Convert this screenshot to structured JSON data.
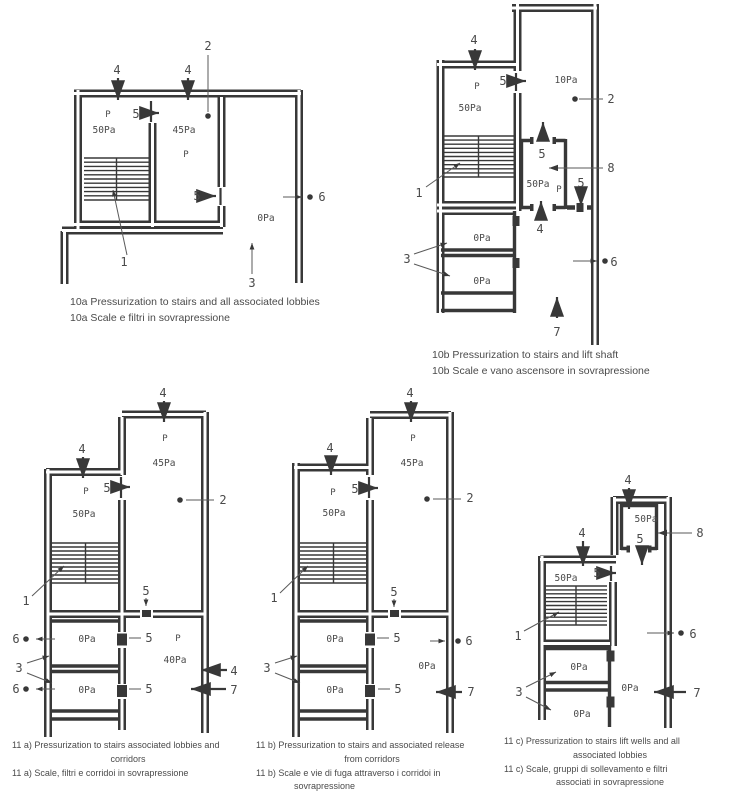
{
  "labels": {
    "n1": "1",
    "n2": "2",
    "n3": "3",
    "n4": "4",
    "n5": "5",
    "n6": "6",
    "n7": "7",
    "n8": "8",
    "p": "P",
    "pa0": "0Pa",
    "pa10": "10Pa",
    "pa40": "40Pa",
    "pa45": "45Pa",
    "pa50": "50Pa"
  },
  "captions": {
    "f10a": {
      "l1": "10a Pressurization to stairs and all associated lobbies",
      "l2": "10a Scale e filtri in sovrapressione"
    },
    "f10b": {
      "l1": "10b Pressurization to stairs and lift shaft",
      "l2": "10b Scale e vano ascensore in sovrapressione"
    },
    "f11a": {
      "l1": "11 a) Pressurization to stairs associated lobbies and",
      "l2": "corridors",
      "l3": "11 a) Scale, filtri e corridoi in sovrapressione"
    },
    "f11b": {
      "l1": "11 b) Pressurization to stairs and associated release",
      "l2": "from corridors",
      "l3": "11 b) Scale e vie di fuga attraverso i corridoi in",
      "l4": "sovrapressione"
    },
    "f11c": {
      "l1": "11 c) Pressurization to stairs lift wells and all",
      "l2": "associated lobbies",
      "l3": "11 c) Scale, gruppi di sollevamento e filtri",
      "l4": "associati in sovrapressione"
    }
  },
  "colors": {
    "line": "#383838",
    "text": "#4a4a4a",
    "background": "#ffffff"
  }
}
